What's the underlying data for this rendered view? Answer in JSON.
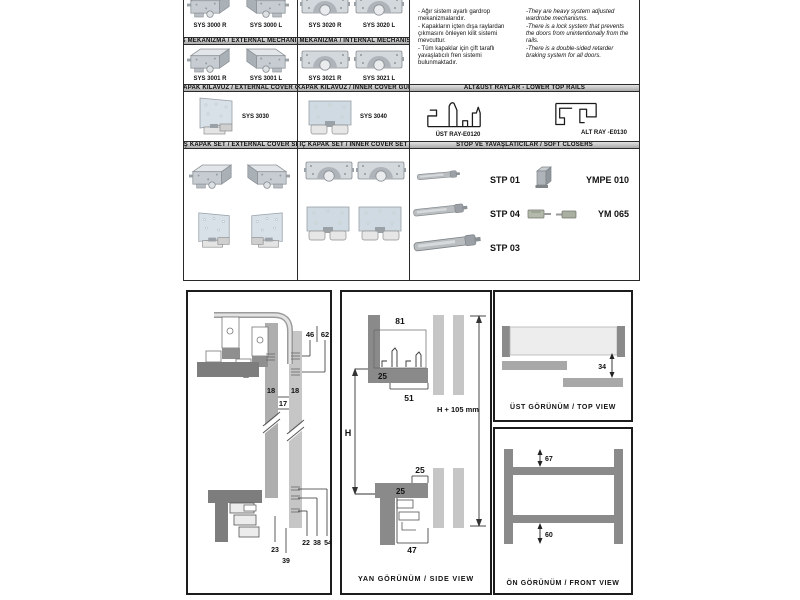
{
  "colors": {
    "profile_dark": "#7d7d7d",
    "profile_mid": "#8a8a8a",
    "bar_gray": "#a8a8a8",
    "door_gray": "#c6c6c6",
    "door_light": "#ededed",
    "line_black": "#1c1c1c"
  },
  "catalog": {
    "headers": {
      "external_mechanism": "DIŞ MEKANİZMA / EXTERNAL MECHANISM",
      "internal_mechanism": "İÇ MEKANİZMA / INTERNAL MECHANISM",
      "external_cover_guide": "DIŞ KAPAK KILAVUZ / EXTERNAL COVER GUIDE",
      "inner_cover_guide": "İÇ KAPAK KILAVUZ / INNER COVER GUIDE",
      "lower_top_rails": "ALT&ÜST RAYLAR - LOWER TOP RAILS",
      "external_cover_set": "DIŞ KAPAK SET / EXTERNAL COVER SET",
      "inner_cover_set": "İÇ KAPAK SET / INNER COVER SET",
      "soft_closers": "STOP VE YAVAŞLATICILAR / SOFT CLOSERS"
    },
    "products": {
      "sys3000r": "SYS 3000 R",
      "sys3000l": "SYS 3000 L",
      "sys3020r": "SYS 3020 R",
      "sys3020l": "SYS 3020 L",
      "sys3001r": "SYS 3001 R",
      "sys3001l": "SYS 3001 L",
      "sys3021r": "SYS 3021 R",
      "sys3021l": "SYS 3021 L",
      "sys3030": "SYS 3030",
      "sys3040": "SYS 3040"
    },
    "description_tr": [
      "- Ağır sistem ayarlı gardrop mekanizmalarıdır.",
      "- Kapakların içten dışa raylardan çıkmasını önleyen kilit sistemi mevcuttur.",
      "- Tüm kapaklar için çift taraflı yavaşlatıcılı fren sistemi bulunmaktadır."
    ],
    "description_en": [
      "-They are heavy system adjusted wardrobe mechanisms.",
      "-There is a lock system that prevents the doors from unintentionally from the rails.",
      "-There is a double-sided retarder braking system for all doors."
    ],
    "rails": {
      "ust_ray": "ÜST RAY-E0120",
      "alt_ray": "ALT RAY -E0130"
    },
    "soft_closers": {
      "stp01": "STP 01",
      "stp04": "STP 04",
      "stp03": "STP 03",
      "ympe010": "YMPE 010",
      "ym065": "YM 065"
    }
  },
  "diagrams": {
    "side_detail": {
      "d46": "46",
      "d62": "62",
      "d18a": "18",
      "d18b": "18",
      "d17": "17",
      "d22": "22",
      "d38": "38",
      "d54": "54",
      "d23": "23",
      "d39": "39"
    },
    "side_view": {
      "caption": "YAN GÖRÜNÜM / SIDE VIEW",
      "d81": "81",
      "d25_top_track": "25",
      "d51": "51",
      "dH": "H",
      "dH105": "H + 105 mm",
      "d25_door": "25",
      "d25_bottom_track": "25",
      "d47": "47"
    },
    "top_view": {
      "caption": "ÜST GÖRÜNÜM / TOP VIEW",
      "d34": "34"
    },
    "front_view": {
      "caption": "ÖN GÖRÜNÜM / FRONT VIEW",
      "d67": "67",
      "d60": "60"
    }
  }
}
